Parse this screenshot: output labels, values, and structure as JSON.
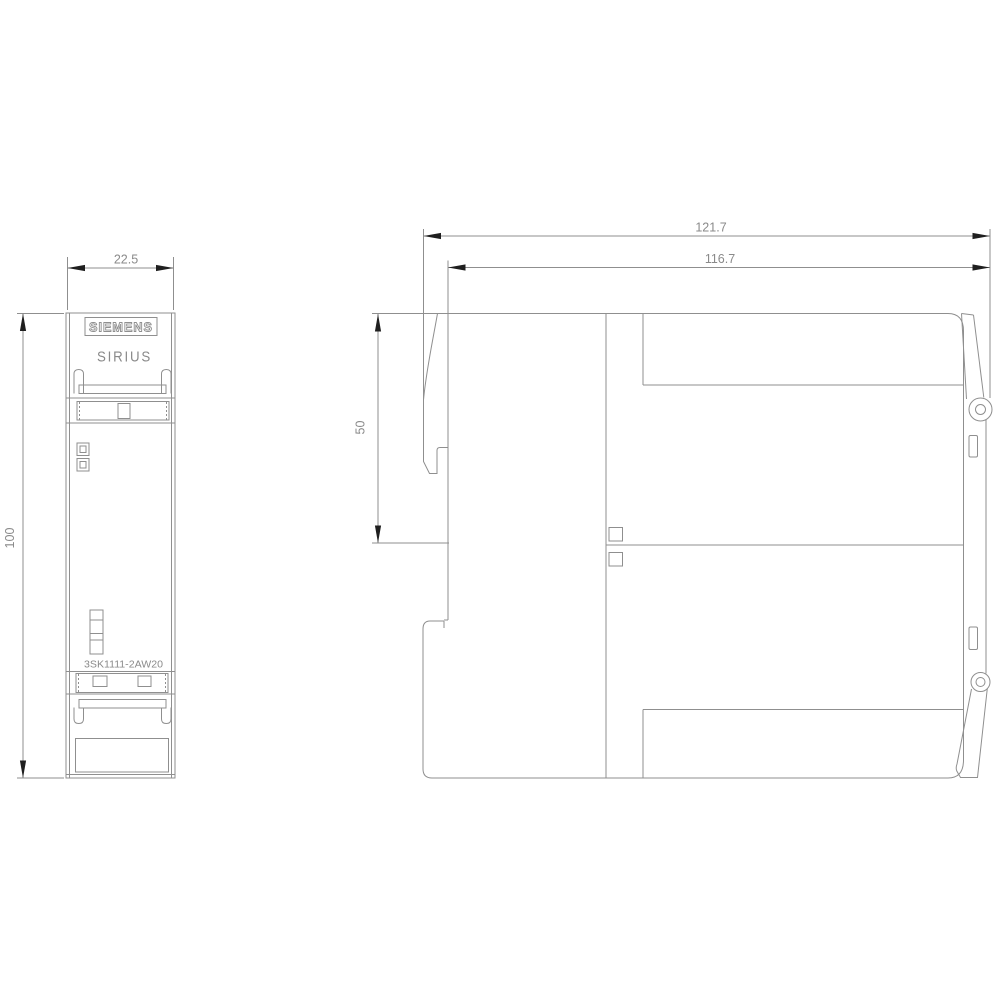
{
  "product": {
    "brand": "SIEMENS",
    "series": "SIRIUS",
    "part_number": "3SK1111-2AW20"
  },
  "dimensions": {
    "front_width": "22.5",
    "front_height": "100",
    "side_total_width": "121.7",
    "side_body_width": "116.7",
    "side_upper_height": "50"
  },
  "colors": {
    "line": "#8f8f8f",
    "text": "#8a8a8a",
    "arrow": "#1f1f1f",
    "bg": "#ffffff"
  }
}
